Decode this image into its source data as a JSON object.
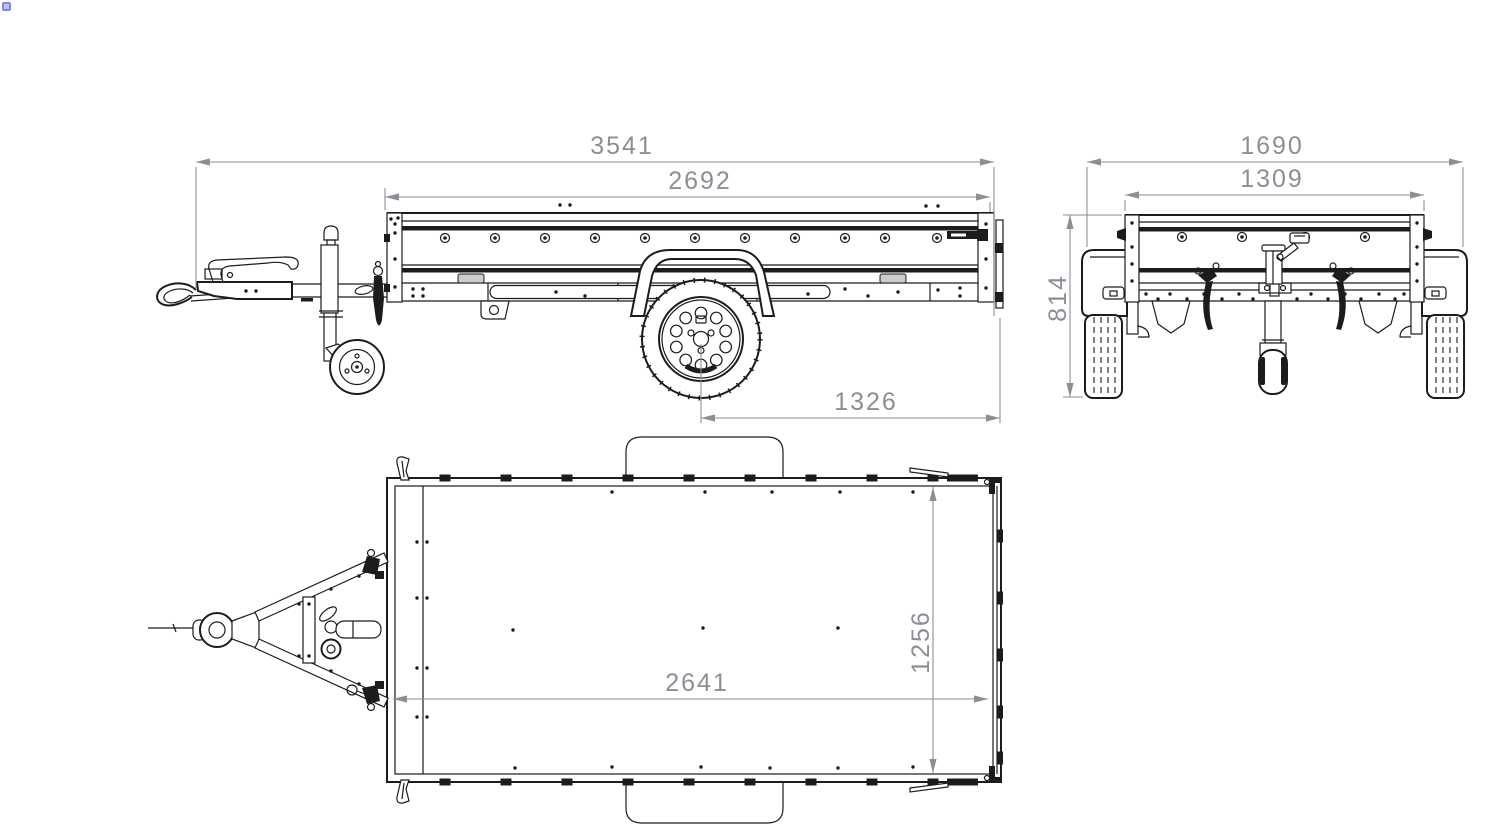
{
  "drawing": {
    "type": "technical-orthographic-drawing",
    "subject": "utility trailer",
    "colors": {
      "line": "#1c1c1e",
      "dimension": "#8a8f96",
      "background": "#ffffff",
      "artifact_dot": "#7e88e8"
    },
    "views": {
      "side": {
        "label": "side view",
        "dims": {
          "overall_length": "3541",
          "bed_length": "2692",
          "axle_to_rear": "1326"
        }
      },
      "rear": {
        "label": "rear view",
        "dims": {
          "overall_width": "1690",
          "body_width": "1309",
          "body_height": "814"
        }
      },
      "top": {
        "label": "top view",
        "dims": {
          "inner_length": "2641",
          "inner_width": "1256"
        }
      }
    }
  }
}
